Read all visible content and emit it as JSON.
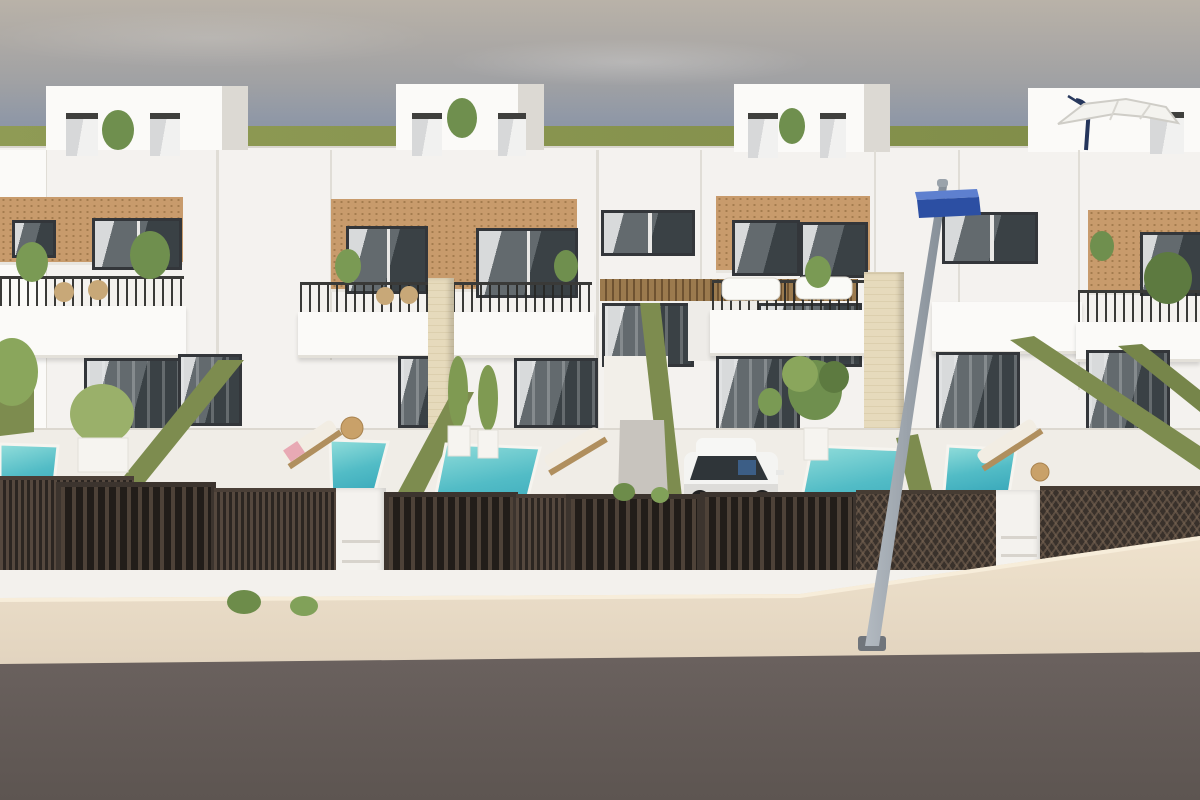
{
  "meta": {
    "domain": "Natural-Image",
    "image_type": "3d-architectural-render",
    "description": "3D architectural rendering, street view of a row of four modern two-storey white Mediterranean townhouses with rooftop penthouses, tan brick accent facades, balconies with dark railings, green privacy hedges, private turquoise plunge pools, wooden sun loungers, dark slatted street fences and gates, a white SUV parked in a driveway, a grey street lamp with a blue sign, a beige sidewalk and a grey asphalt road in the foreground.",
    "visible_text": "none"
  },
  "palette": {
    "sky_top": "#b9b2a8",
    "sky_mid": "#a0a1a4",
    "sky_low": "#8e97a6",
    "grass": "#8f9b55",
    "grass_dark": "#7f8c48",
    "wall": "#f4f2ef",
    "wall_bright": "#fbfaf8",
    "wall_shade": "#e6e3dd",
    "seam": "#e0ddd6",
    "terrace": "#f0ede7",
    "base_wall": "#f3f1ed",
    "brick": "#c89b6c",
    "brick_dot": "#a47c4e",
    "cream": "#e6dabc",
    "frame": "#33363a",
    "glass_a": "#636a6e",
    "glass_b": "#3a4145",
    "glass_light": "#d8dadb",
    "hedge": "#7d8c4f",
    "hedge_dark": "#66753f",
    "pool_a": "#93dedb",
    "pool_b": "#3aa9bb",
    "fence_slat": "#55483e",
    "fence_gap": "#2b2521",
    "gate_frame": "#3c342e",
    "pillar": "#f4f2ee",
    "sidewalk_a": "#efe2cd",
    "sidewalk_b": "#e2d4bf",
    "sidewalk_lip": "#f7edda",
    "road_a": "#6c6360",
    "road_b": "#5d5551",
    "pole_a": "#b3bac1",
    "pole_b": "#848d96",
    "sign": "#2c4fa3",
    "sign_top": "#5e80cf",
    "wood": "#c9a169",
    "wood_dark": "#a9834f",
    "cushion": "#f2ede3",
    "towel": "#e8a9b4",
    "car": "#f4f4f2",
    "car_shade": "#dddcd9",
    "car_glass": "#2f3539",
    "plant": "#6f8f4e",
    "plant_light": "#8aa65c",
    "plant_dark": "#55703c",
    "canopy_a": "#9b7a4e",
    "canopy_b": "#6e5231",
    "walkway_strip": "#c8c4be"
  },
  "scene": {
    "sky": {
      "type": "hazy overcast gradient",
      "clouds": "faint streaks"
    },
    "horizon": {
      "type": "flat green field band"
    },
    "villas": [
      {
        "id": 1,
        "position": "left",
        "floors": 2,
        "penthouse": true,
        "brick_accent": true,
        "balcony": "dark railing, rattan chairs, potted plants",
        "pool": "corner plunge pool",
        "lounger": "wooden lounger with pink towel"
      },
      {
        "id": 2,
        "position": "center-left",
        "floors": 2,
        "penthouse": true,
        "brick_accent": true,
        "balcony": "dark railing with planters",
        "pool": "two plunge pools on terrace",
        "lounger": "wooden lounger with white cushion"
      },
      {
        "id": 3,
        "position": "center-right",
        "floors": 2,
        "penthouse": true,
        "brick_accent": true,
        "balcony": "white outdoor sofas and plant",
        "pool": "plunge pool beside driveway",
        "driveway": "white SUV behind slatted gate"
      },
      {
        "id": 4,
        "position": "right",
        "floors": 2,
        "penthouse": true,
        "brick_accent": true,
        "balcony": "dark railing",
        "pool": "plunge pool",
        "lounger": "wooden lounger",
        "roof_parasol": "white cantilever parasol"
      }
    ],
    "central_passage": {
      "canopy": "wood slats",
      "doors": "black-framed glass",
      "walkway": "light path to street gate"
    },
    "pools": {
      "count": 5,
      "color": "turquoise"
    },
    "loungers": {
      "count": 3
    },
    "street": {
      "fences": "dark brown slatted fences and gates, some with diagonal lattice",
      "mailbox_pillars": 2,
      "lamppost": {
        "pole": "grey, leaning",
        "sign": "blue rectangular box sign"
      },
      "sidewalk": "beige pavement strip",
      "road": "dark warm-grey asphalt"
    },
    "vehicle": {
      "type": "SUV",
      "color": "white",
      "location": "driveway of villa 3"
    },
    "vegetation": [
      "rooftop potted plants",
      "balcony plants",
      "tall grass planters",
      "palm by passage",
      "green hedge walls",
      "small shrub tufts by street"
    ]
  }
}
